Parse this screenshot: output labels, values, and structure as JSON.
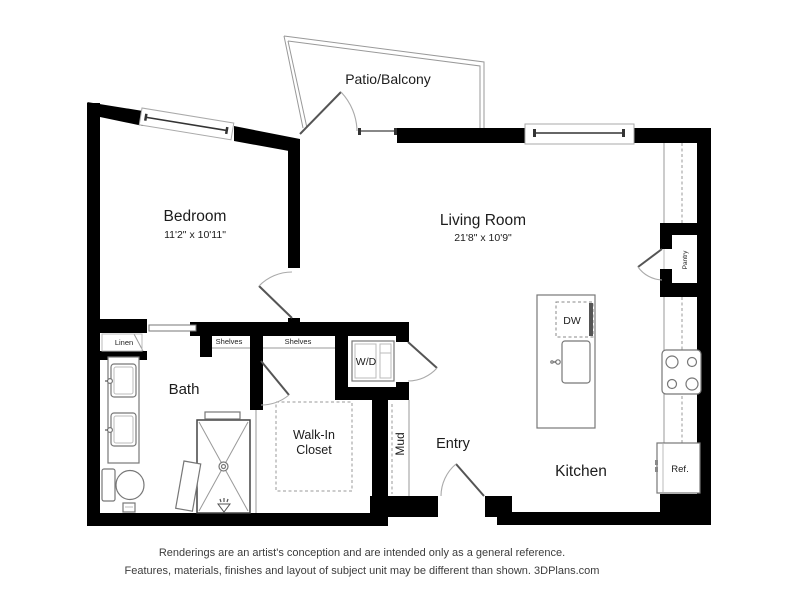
{
  "labels": {
    "patio": "Patio/Balcony",
    "bedroom": "Bedroom",
    "bedroom_dims": "11'2\" x 10'11\"",
    "living_room": "Living Room",
    "living_room_dims": "21'8\" x 10'9\"",
    "bath": "Bath",
    "walk_in_line1": "Walk-In",
    "walk_in_line2": "Closet",
    "entry": "Entry",
    "kitchen": "Kitchen",
    "mud": "Mud",
    "pantry": "Pantry",
    "washer_dryer": "W/D",
    "dishwasher": "DW",
    "refrigerator": "Ref.",
    "linen": "Linen",
    "shelves_left": "Shelves",
    "shelves_right": "Shelves"
  },
  "footer": {
    "line1": "Renderings are an artist's conception and are intended only as a general reference.",
    "line2": "Features, materials, finishes and layout of subject unit may be different than shown. 3DPlans.com"
  },
  "colors": {
    "wall": "#000000",
    "fixture_line": "#999999",
    "label_text": "#1c1c1c",
    "footer_text": "#3c3c3c",
    "background": "#ffffff"
  }
}
